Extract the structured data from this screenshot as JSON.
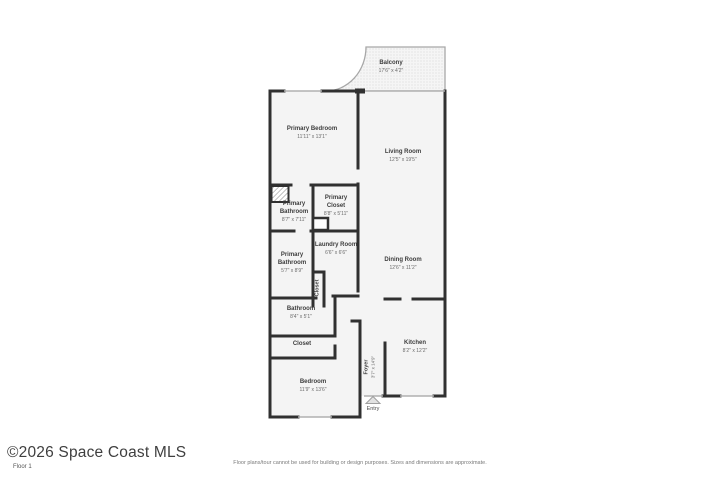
{
  "floorplan": {
    "watermark": "©2026 Space Coast MLS",
    "floor_label": "Floor 1",
    "disclaimer": "Floor plans/tour cannot be used for building or design purposes. Sizes and dimensions are approximate.",
    "entry_label": "Entry",
    "rooms": [
      {
        "name": "Balcony",
        "dims": "17'6\" x 4'2\""
      },
      {
        "name": "Primary Bedroom",
        "dims": "11'11\" x 13'1\""
      },
      {
        "name": "Living Room",
        "dims": "12'5\" x 19'5\""
      },
      {
        "name": "Primary Bathroom",
        "dims": "8'7\" x 7'11\""
      },
      {
        "name": "Primary Closet",
        "dims": "8'8\" x 5'11\""
      },
      {
        "name": "Laundry Room",
        "dims": "6'6\" x 6'6\""
      },
      {
        "name": "Primary Bathroom",
        "dims": "5'7\" x 8'9\""
      },
      {
        "name": "Closet"
      },
      {
        "name": "Dining Room",
        "dims": "12'6\" x 11'2\""
      },
      {
        "name": "Bathroom",
        "dims": "8'4\" x 5'1\""
      },
      {
        "name": "Closet"
      },
      {
        "name": "Bedroom",
        "dims": "11'9\" x 13'6\""
      },
      {
        "name": "Foyer",
        "dims": "3'7\" x 14'9\""
      },
      {
        "name": "Kitchen",
        "dims": "8'2\" x 12'2\""
      }
    ],
    "colors": {
      "wall": "#303030",
      "floor_fill": "#f4f4f4",
      "thin_wall": "#aaaaaa",
      "label_text": "#3d3d3d"
    }
  }
}
